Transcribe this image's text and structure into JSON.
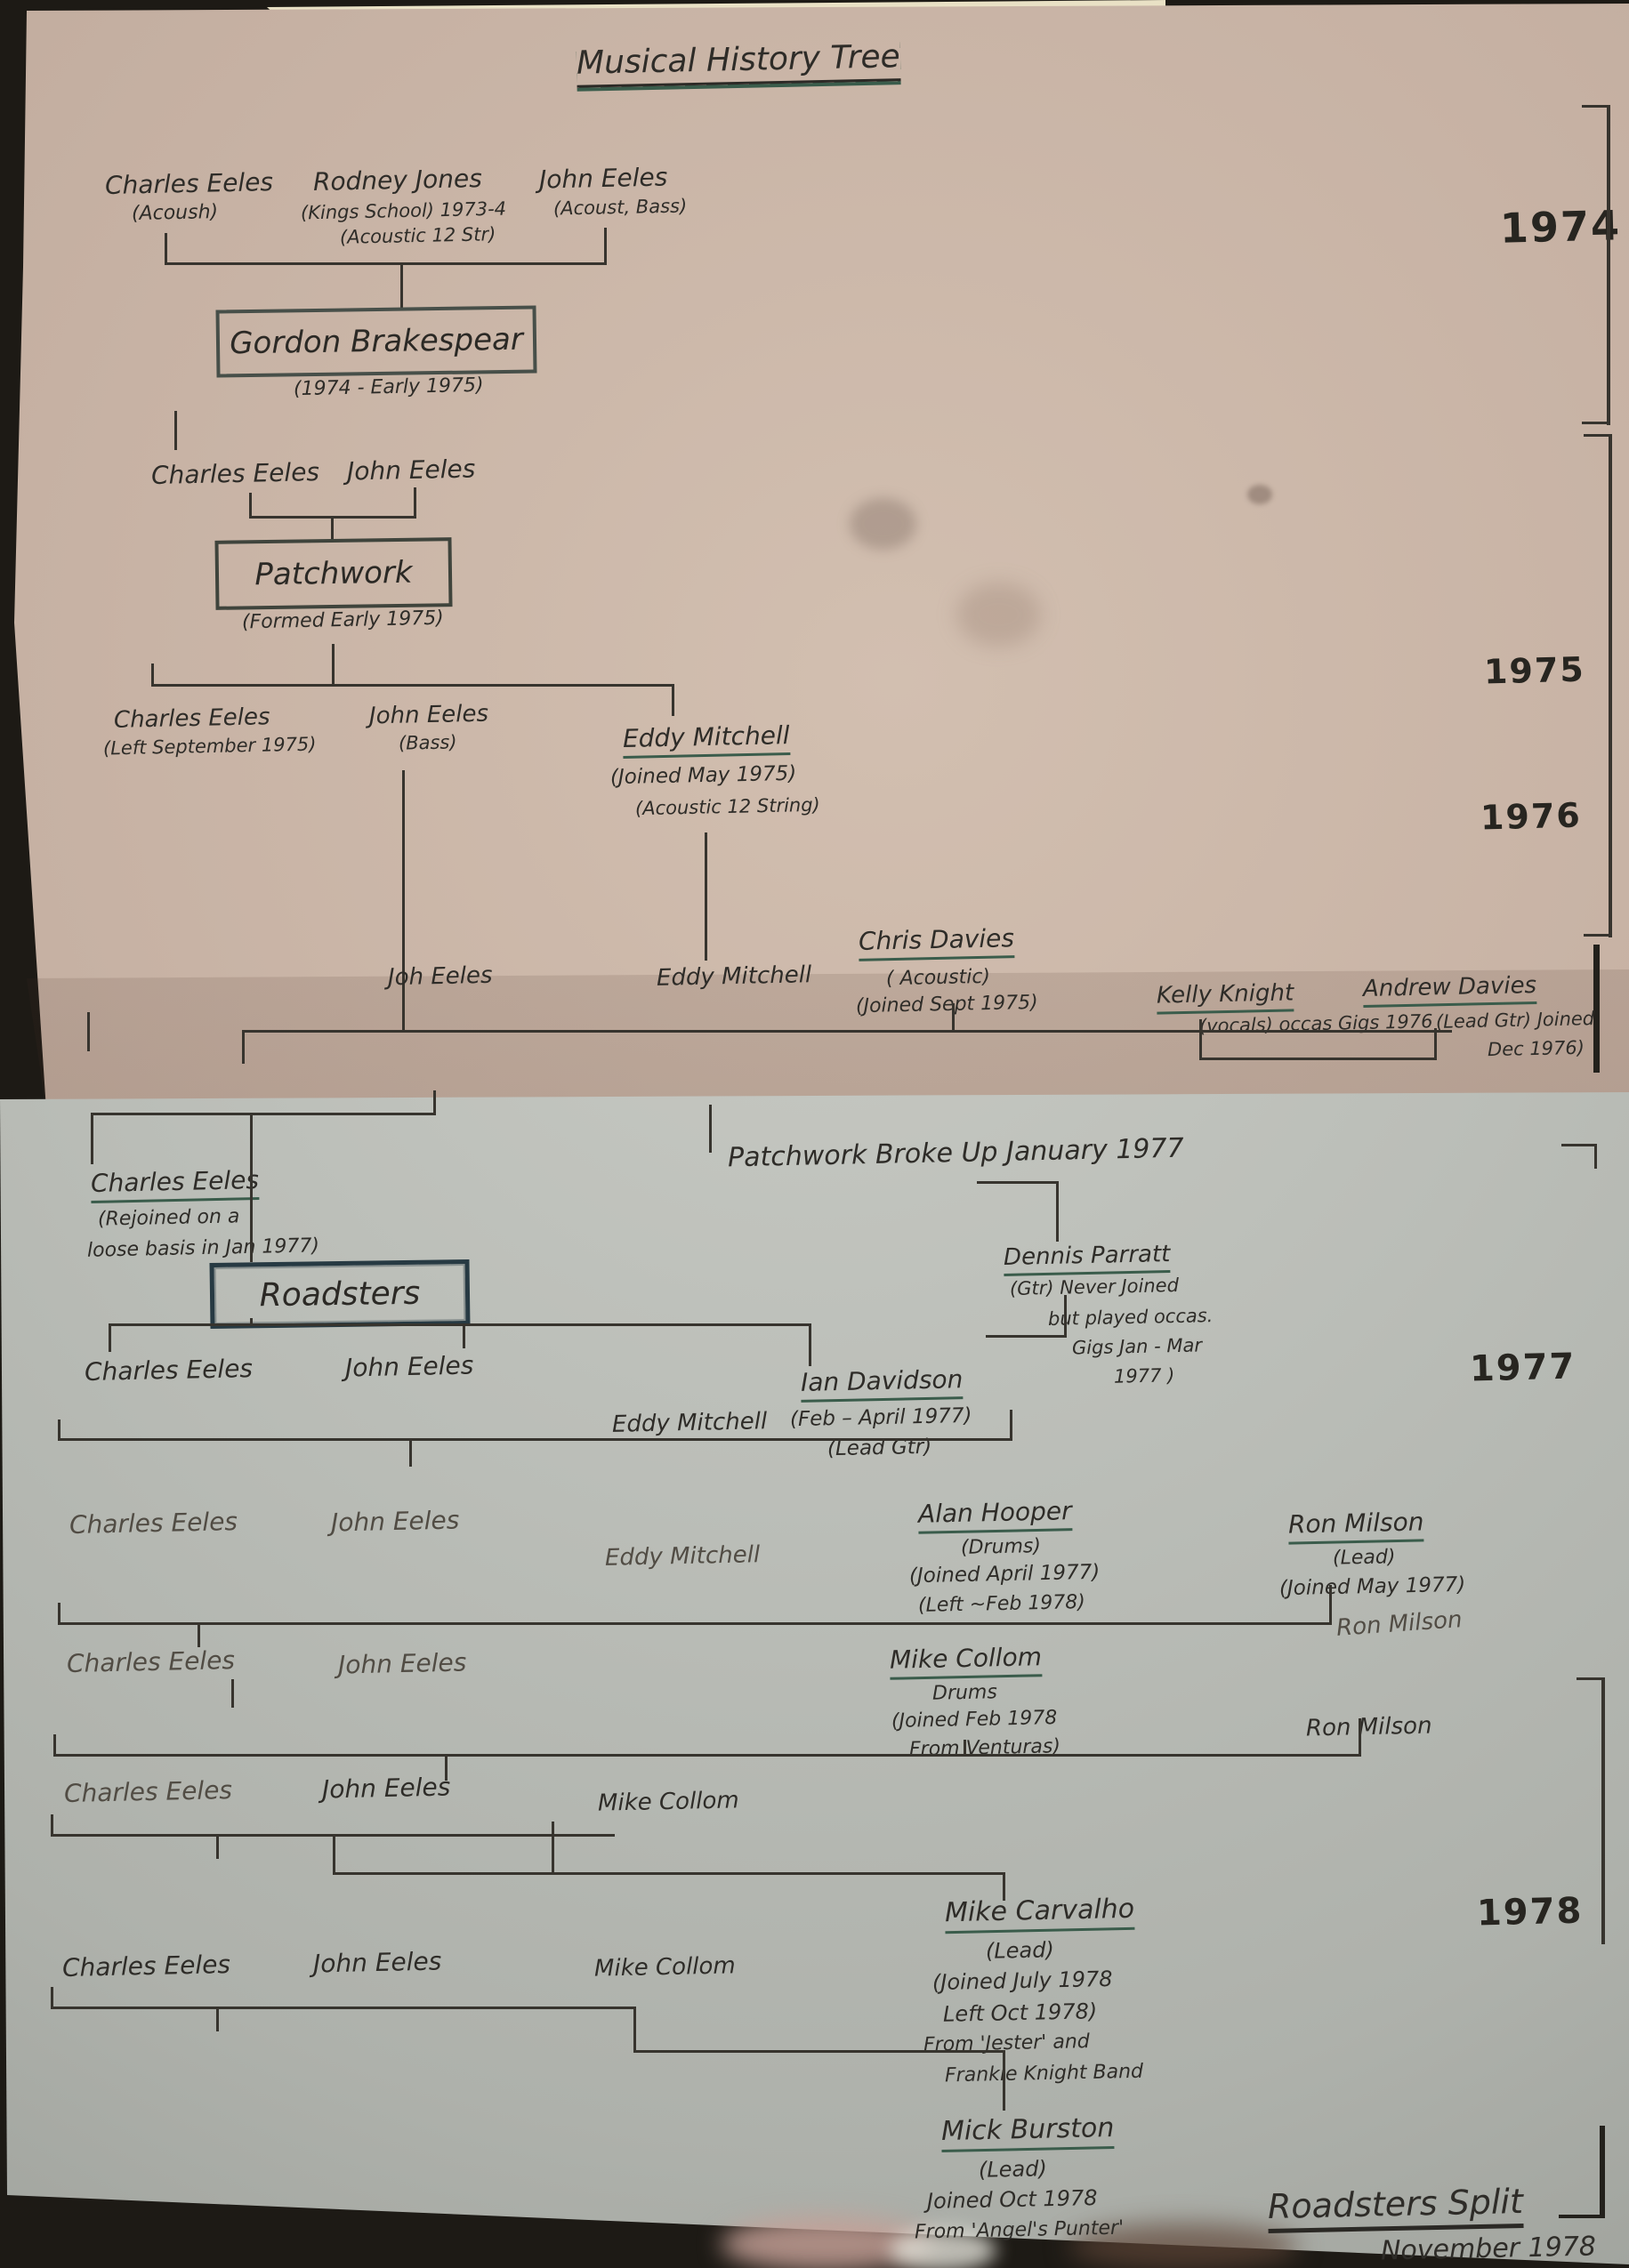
{
  "title": "Musical History Tree",
  "top": {
    "years": {
      "y1974": "1974",
      "y1975": "1975",
      "y1976": "1976"
    },
    "gen1974": {
      "charles": {
        "name": "Charles Eeles",
        "note1": "(Acoush)"
      },
      "rodney": {
        "name": "Rodney Jones",
        "note1": "(Kings School) 1973-4",
        "note2": "(Acoustic 12 Str)"
      },
      "john": {
        "name": "John Eeles",
        "note1": "(Acoust, Bass)"
      }
    },
    "gordon": {
      "name": "Gordon Brakespear",
      "dates": "(1974 - Early 1975)"
    },
    "pre_patchwork": {
      "charles": "Charles Eeles",
      "john": "John Eeles"
    },
    "patchwork": {
      "name": "Patchwork",
      "dates": "(Formed Early 1975)"
    },
    "gen1975": {
      "charles": {
        "name": "Charles Eeles",
        "note1": "(Left September 1975)"
      },
      "john": {
        "name": "John Eeles",
        "note1": "(Bass)"
      },
      "eddy": {
        "name": "Eddy Mitchell",
        "note1": "(Joined May 1975)",
        "note2": "(Acoustic 12 String)"
      }
    },
    "gen1976": {
      "john": "Joh Eeles",
      "eddy": "Eddy Mitchell",
      "chris": {
        "name": "Chris Davies",
        "note1": "( Acoustic)",
        "note2": "(Joined Sept 1975)"
      },
      "kelly": {
        "name": "Kelly Knight",
        "note1": "(vocals) occas Gigs 1976"
      },
      "andrew": {
        "name": "Andrew Davies",
        "note1": "(Lead Gtr) Joined",
        "note2": "Dec 1976)"
      }
    }
  },
  "bottom": {
    "years": {
      "y1977": "1977",
      "y1978": "1978"
    },
    "break_note": "Patchwork Broke Up January 1977",
    "charles_rejoin": {
      "name": "Charles Eeles",
      "note1": "(Rejoined on a",
      "note2": "loose basis in Jan 1977)"
    },
    "roadsters": {
      "name": "Roadsters"
    },
    "dennis": {
      "name": "Dennis Parratt",
      "note1": "(Gtr) Never Joined",
      "note2": "but played occas.",
      "note3": "Gigs Jan - Mar",
      "note4": "1977 )"
    },
    "rowA": {
      "charles": "Charles Eeles",
      "john": "John Eeles",
      "eddy": "Eddy Mitchell",
      "ian": {
        "name": "Ian Davidson",
        "note1": "(Feb – April 1977)",
        "note2": "(Lead Gtr)"
      }
    },
    "rowB": {
      "charles": "Charles Eeles",
      "john": "John Eeles",
      "eddy": "Eddy Mitchell",
      "alan": {
        "name": "Alan Hooper",
        "note1": "(Drums)",
        "note2": "(Joined April 1977)",
        "note3": "(Left ~Feb 1978)"
      },
      "ron": {
        "name": "Ron Milson",
        "note1": "(Lead)",
        "note2": "(Joined May 1977)"
      },
      "ron_scribble": "Ron Milson"
    },
    "rowC": {
      "charles": "Charles Eeles",
      "john": "John Eeles",
      "mike": {
        "name": "Mike Collom",
        "note1": "Drums",
        "note2": "(Joined Feb 1978",
        "note3": "From Venturas)"
      },
      "ron": "Ron Milson"
    },
    "rowD": {
      "charles": "Charles Eeles",
      "john": "John Eeles",
      "mike": "Mike Collom"
    },
    "carvalho": {
      "name": "Mike Carvalho",
      "note1": "(Lead)",
      "note2": "(Joined July 1978",
      "note3": "Left Oct 1978)",
      "note4": "From 'Jester' and",
      "note5": "Frankie Knight Band"
    },
    "rowE": {
      "charles": "Charles Eeles",
      "john": "John Eeles",
      "mike": "Mike Collom"
    },
    "burston": {
      "name": "Mick Burston",
      "note1": "(Lead)",
      "note2": "Joined Oct 1978",
      "note3": "From 'Angel's Punter'"
    },
    "split": {
      "title": "Roadsters Split",
      "date": "November 1978"
    }
  },
  "colors": {
    "ink": "#2e2c28",
    "underline_green": "#3a5c4b",
    "paper_top": "#c8b3a6",
    "paper_bottom": "#b8bbb5"
  }
}
